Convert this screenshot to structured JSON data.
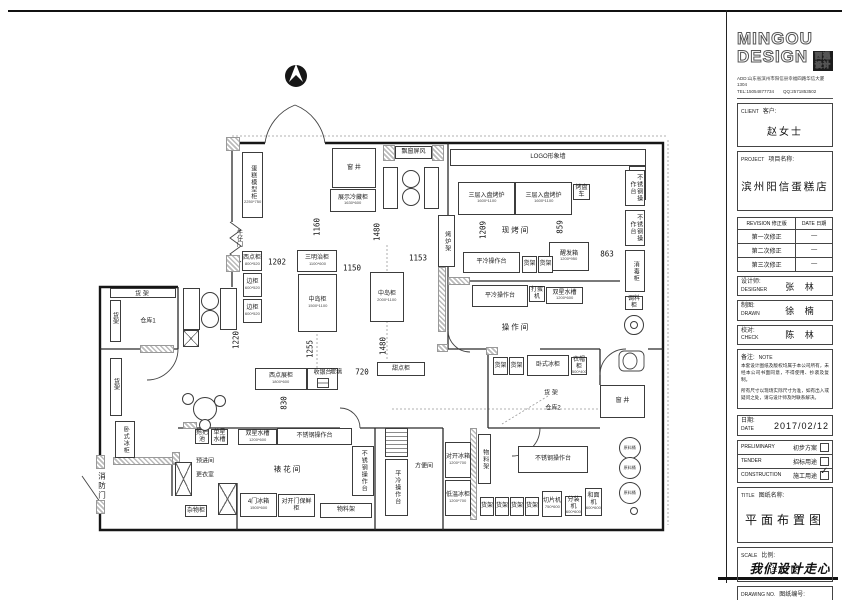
{
  "title_block": {
    "logo_line1": "MINGOU",
    "logo_line2": "DESIGN",
    "stamp_line1": "西遇",
    "stamp_line2": "设计",
    "address": "ADD:山东省滨州市阳信县幸福四路华信大厦1304",
    "tel": "TEL:15054877734　　QQ:2571853502",
    "client_en": "CLIENT",
    "client_cn": "客户:",
    "client_value": "赵女士",
    "project_en": "PROJECT",
    "project_cn": "项目名称:",
    "project_value": "滨州阳信蛋糕店",
    "revision_en": "REVISION",
    "revision_cn": "修正版",
    "date_en": "DATE",
    "date_cn": "日期",
    "revision_rows": [
      {
        "label": "第一次修正",
        "date": "—"
      },
      {
        "label": "第二次修正",
        "date": "—"
      },
      {
        "label": "第三次修正",
        "date": "—"
      }
    ],
    "designer_cn": "设计师:",
    "designer_en": "DESIGNER",
    "designer_value": "张 林",
    "drawn_cn": "制图:",
    "drawn_en": "DRAWN",
    "drawn_value": "徐 楠",
    "check_cn": "校对:",
    "check_en": "CHECK",
    "check_value": "陈 林",
    "note_cn": "备注:",
    "note_en": "NOTE",
    "note_text1": "本套设计图纸及版权均属于本公司所有，未经本公司书面同意，不得使用、抄袭及复制。",
    "note_text2": "所有尺寸以现场实际尺寸为准，如有出入或疑问之处，请与设计师及时联系解决。",
    "date_label_cn": "日期:",
    "date_label_en": "DATE",
    "date_value": "2017/02/12",
    "usage_rows": [
      {
        "en": "PRELIMINARY",
        "cn": "初步方案",
        "checked": false
      },
      {
        "en": "TENDER",
        "cn": "招标用途",
        "checked": false
      },
      {
        "en": "CONSTRUCTION",
        "cn": "施工用途",
        "checked": true
      }
    ],
    "title_en": "TITLE",
    "title_cn": "图纸名称:",
    "title_value": "平面布置图",
    "scale_en": "SCALE",
    "scale_cn": "比例:",
    "scale_value": "详见图",
    "dwgno_en": "DRAWING NO.",
    "dwgno_cn": "图纸编号:",
    "dwgno_value": "D-08",
    "slogan": "我们设计走心"
  },
  "plan": {
    "fixtures": [
      {
        "label": "蛋糕模型柜",
        "sub": "2250*750",
        "x": 242,
        "y": 152,
        "w": 21,
        "h": 66,
        "v": 1
      },
      {
        "label": "窗 井",
        "x": 332,
        "y": 148,
        "w": 44,
        "h": 40
      },
      {
        "label": "展示冷藏柜",
        "sub": "1630*600",
        "x": 330,
        "y": 189,
        "w": 46,
        "h": 23
      },
      {
        "label": "飘窗屏风",
        "x": 395,
        "y": 146,
        "w": 37,
        "h": 13
      },
      {
        "label": "",
        "x": 383,
        "y": 167,
        "w": 15,
        "h": 42
      },
      {
        "label": "",
        "x": 424,
        "y": 167,
        "w": 15,
        "h": 42
      },
      {
        "label": "LOGO形象墙",
        "x": 450,
        "y": 149,
        "w": 196,
        "h": 17
      },
      {
        "label": "",
        "x": 629,
        "y": 166,
        "w": 17,
        "h": 34
      },
      {
        "label": "三层入盘烤炉",
        "sub": "1600*1100",
        "x": 458,
        "y": 182,
        "w": 57,
        "h": 33
      },
      {
        "label": "三层入盘烤炉",
        "sub": "1600*1100",
        "x": 515,
        "y": 182,
        "w": 57,
        "h": 33
      },
      {
        "label": "烤盘车",
        "x": 573,
        "y": 184,
        "w": 17,
        "h": 16
      },
      {
        "label": "烤炉架",
        "x": 438,
        "y": 215,
        "w": 17,
        "h": 52,
        "v": 1
      },
      {
        "label": "不锈钢操作台",
        "x": 625,
        "y": 170,
        "w": 20,
        "h": 36,
        "v": 1
      },
      {
        "label": "不锈钢操作台",
        "x": 625,
        "y": 210,
        "w": 20,
        "h": 36,
        "v": 1
      },
      {
        "label": "消毒柜",
        "x": 625,
        "y": 250,
        "w": 20,
        "h": 42,
        "v": 1
      },
      {
        "label": "调料柜",
        "x": 625,
        "y": 296,
        "w": 18,
        "h": 14
      },
      {
        "label": "醒发箱",
        "sub": "1200*950",
        "x": 549,
        "y": 242,
        "w": 40,
        "h": 29
      },
      {
        "label": "平冷操作台",
        "x": 463,
        "y": 252,
        "w": 57,
        "h": 21
      },
      {
        "label": "货架",
        "x": 522,
        "y": 256,
        "w": 15,
        "h": 17
      },
      {
        "label": "货架",
        "x": 538,
        "y": 256,
        "w": 15,
        "h": 17
      },
      {
        "label": "平冷操作台",
        "x": 472,
        "y": 285,
        "w": 56,
        "h": 22
      },
      {
        "label": "打蛋机",
        "x": 529,
        "y": 286,
        "w": 16,
        "h": 16
      },
      {
        "label": "双星水槽",
        "sub": "1200*600",
        "x": 546,
        "y": 287,
        "w": 37,
        "h": 17
      },
      {
        "label": "三明治柜",
        "sub": "1100*600",
        "x": 297,
        "y": 250,
        "w": 40,
        "h": 22
      },
      {
        "label": "中岛柜",
        "sub": "1500*1100",
        "x": 298,
        "y": 274,
        "w": 39,
        "h": 58
      },
      {
        "label": "中岛柜",
        "sub": "2000*1100",
        "x": 370,
        "y": 272,
        "w": 34,
        "h": 50
      },
      {
        "label": "西点柜",
        "sub": "800*520",
        "x": 242,
        "y": 251,
        "w": 20,
        "h": 20
      },
      {
        "label": "边柜",
        "sub": "600*520",
        "x": 243,
        "y": 273,
        "w": 19,
        "h": 24
      },
      {
        "label": "边柜",
        "sub": "600*520",
        "x": 243,
        "y": 299,
        "w": 19,
        "h": 24
      },
      {
        "label": "西点展柜",
        "sub": "1800*600",
        "x": 255,
        "y": 368,
        "w": 52,
        "h": 22
      },
      {
        "label": "收银台",
        "x": 307,
        "y": 368,
        "w": 31,
        "h": 22,
        "type": "cashier"
      },
      {
        "label": "甜点柜",
        "x": 377,
        "y": 362,
        "w": 48,
        "h": 14
      },
      {
        "label": "货架",
        "x": 493,
        "y": 357,
        "w": 15,
        "h": 18
      },
      {
        "label": "货架",
        "x": 509,
        "y": 357,
        "w": 15,
        "h": 18
      },
      {
        "label": "卧式冰柜",
        "x": 527,
        "y": 355,
        "w": 42,
        "h": 21
      },
      {
        "label": "衣帽柜",
        "sub": "500*400",
        "x": 571,
        "y": 357,
        "w": 16,
        "h": 18
      },
      {
        "label": "窗 井",
        "x": 600,
        "y": 385,
        "w": 45,
        "h": 33
      },
      {
        "label": "不锈钢操作台",
        "x": 518,
        "y": 446,
        "w": 70,
        "h": 27
      },
      {
        "label": "货架",
        "x": 480,
        "y": 497,
        "w": 14,
        "h": 19
      },
      {
        "label": "货架",
        "x": 495,
        "y": 497,
        "w": 14,
        "h": 19
      },
      {
        "label": "货架",
        "x": 510,
        "y": 497,
        "w": 14,
        "h": 19
      },
      {
        "label": "货架",
        "x": 525,
        "y": 497,
        "w": 14,
        "h": 19
      },
      {
        "label": "切片机",
        "sub": "750*600",
        "x": 542,
        "y": 491,
        "w": 20,
        "h": 26
      },
      {
        "label": "分装机",
        "sub": "600*600",
        "x": 565,
        "y": 496,
        "w": 17,
        "h": 20
      },
      {
        "label": "和面机",
        "sub": "600*600",
        "x": 585,
        "y": 488,
        "w": 17,
        "h": 28
      },
      {
        "label": "物料架",
        "x": 478,
        "y": 434,
        "w": 13,
        "h": 50,
        "v": 1
      },
      {
        "label": "对开冰箱",
        "sub": "1200*700",
        "x": 445,
        "y": 442,
        "w": 26,
        "h": 36
      },
      {
        "label": "低温冰柜",
        "sub": "1200*700",
        "x": 445,
        "y": 480,
        "w": 26,
        "h": 36
      },
      {
        "label": "平冷操作台",
        "x": 385,
        "y": 459,
        "w": 23,
        "h": 57,
        "v": 1
      },
      {
        "label": "",
        "x": 385,
        "y": 428,
        "w": 23,
        "h": 29,
        "type": "rack"
      },
      {
        "label": "不锈钢操作台",
        "x": 352,
        "y": 446,
        "w": 22,
        "h": 50,
        "v": 1
      },
      {
        "label": "物料架",
        "x": 320,
        "y": 503,
        "w": 52,
        "h": 15
      },
      {
        "label": "对开门保鲜柜",
        "x": 278,
        "y": 494,
        "w": 37,
        "h": 23
      },
      {
        "label": "4门冰箱",
        "sub": "1500*600",
        "x": 240,
        "y": 493,
        "w": 37,
        "h": 24
      },
      {
        "label": "杂物柜",
        "x": 185,
        "y": 505,
        "w": 22,
        "h": 12
      },
      {
        "label": "不锈钢操作台",
        "x": 277,
        "y": 428,
        "w": 75,
        "h": 17
      },
      {
        "label": "双星水槽",
        "sub": "1200*600",
        "x": 238,
        "y": 429,
        "w": 39,
        "h": 16
      },
      {
        "label": "单星水槽",
        "x": 211,
        "y": 429,
        "w": 17,
        "h": 16
      },
      {
        "label": "拖把池",
        "x": 195,
        "y": 429,
        "w": 14,
        "h": 15
      },
      {
        "label": "卧式冰柜",
        "x": 115,
        "y": 421,
        "w": 20,
        "h": 37,
        "v": 1
      },
      {
        "label": "",
        "x": 183,
        "y": 288,
        "w": 17,
        "h": 42
      },
      {
        "label": "",
        "x": 220,
        "y": 288,
        "w": 17,
        "h": 42
      },
      {
        "label": "",
        "x": 183,
        "y": 330,
        "w": 16,
        "h": 17,
        "type": "xbox"
      },
      {
        "label": "",
        "x": 175,
        "y": 462,
        "w": 17,
        "h": 34,
        "type": "xbox"
      },
      {
        "label": "",
        "x": 218,
        "y": 483,
        "w": 19,
        "h": 32,
        "type": "xbox"
      },
      {
        "label": "",
        "x": 110,
        "y": 288,
        "w": 66,
        "h": 10
      },
      {
        "label": "",
        "x": 110,
        "y": 300,
        "w": 11,
        "h": 42
      },
      {
        "label": "",
        "x": 110,
        "y": 358,
        "w": 12,
        "h": 58
      }
    ],
    "rooms": [
      {
        "t": "现烤间",
        "x": 516,
        "y": 230
      },
      {
        "t": "操作间",
        "x": 516,
        "y": 327
      },
      {
        "t": "裱花间",
        "x": 288,
        "y": 469
      },
      {
        "t": "方便间",
        "x": 424,
        "y": 465,
        "small": 1
      },
      {
        "t": "仓库1",
        "x": 148,
        "y": 320,
        "small": 1
      },
      {
        "t": "仓库2",
        "x": 553,
        "y": 407,
        "small": 1
      },
      {
        "t": "货 架",
        "x": 142,
        "y": 293,
        "small": 1
      },
      {
        "t": "货架",
        "x": 115,
        "y": 318,
        "v": 1,
        "small": 1
      },
      {
        "t": "货架",
        "x": 116,
        "y": 384,
        "v": 1,
        "small": 1
      },
      {
        "t": "货 架",
        "x": 551,
        "y": 392,
        "small": 1
      },
      {
        "t": "牛仔门",
        "x": 239,
        "y": 238,
        "v": 1,
        "small": 1
      },
      {
        "t": "消防门",
        "x": 102,
        "y": 486,
        "v": 1
      },
      {
        "t": "预进间",
        "x": 205,
        "y": 460,
        "small": 1
      },
      {
        "t": "更衣室",
        "x": 205,
        "y": 474,
        "small": 1
      },
      {
        "t": "玻璃",
        "x": 336,
        "y": 371,
        "small": 1
      },
      {
        "t": "圆桌",
        "x": 204,
        "y": 408,
        "small": 1
      }
    ],
    "dims": [
      {
        "t": "1202",
        "x": 277,
        "y": 262
      },
      {
        "t": "1150",
        "x": 352,
        "y": 268
      },
      {
        "t": "1153",
        "x": 418,
        "y": 258
      },
      {
        "t": "863",
        "x": 607,
        "y": 254
      },
      {
        "t": "720",
        "x": 362,
        "y": 372
      },
      {
        "t": "1160",
        "x": 317,
        "y": 227,
        "v": 1
      },
      {
        "t": "1480",
        "x": 377,
        "y": 232,
        "v": 1
      },
      {
        "t": "1209",
        "x": 483,
        "y": 230,
        "v": 1
      },
      {
        "t": "859",
        "x": 560,
        "y": 227,
        "v": 1
      },
      {
        "t": "1220",
        "x": 236,
        "y": 340,
        "v": 1
      },
      {
        "t": "1255",
        "x": 310,
        "y": 349,
        "v": 1
      },
      {
        "t": "1480",
        "x": 383,
        "y": 346,
        "v": 1
      },
      {
        "t": "830",
        "x": 284,
        "y": 403,
        "v": 1
      }
    ],
    "circles": [
      {
        "cx": 410,
        "cy": 178,
        "r": 8
      },
      {
        "cx": 410,
        "cy": 196,
        "r": 8
      },
      {
        "cx": 209,
        "cy": 300,
        "r": 8
      },
      {
        "cx": 209,
        "cy": 318,
        "r": 8
      },
      {
        "cx": 204,
        "cy": 408,
        "r": 11
      },
      {
        "cx": 187,
        "cy": 398,
        "r": 5
      },
      {
        "cx": 219,
        "cy": 400,
        "r": 5
      },
      {
        "cx": 204,
        "cy": 424,
        "r": 5
      },
      {
        "label": "原料桶",
        "cx": 629,
        "cy": 447,
        "r": 10
      },
      {
        "label": "原料桶",
        "cx": 629,
        "cy": 467,
        "r": 10
      },
      {
        "label": "原料桶",
        "cx": 629,
        "cy": 492,
        "r": 10
      },
      {
        "cx": 633,
        "cy": 510,
        "r": 3
      },
      {
        "cx": 633,
        "cy": 324,
        "r": 9
      },
      {
        "cx": 633,
        "cy": 324,
        "r": 3
      }
    ],
    "hatches": [
      [
        226,
        137,
        14,
        14
      ],
      [
        226,
        255,
        14,
        17
      ],
      [
        332,
        148,
        8,
        40
      ],
      [
        368,
        148,
        8,
        40
      ],
      [
        383,
        145,
        12,
        16
      ],
      [
        432,
        145,
        12,
        16
      ],
      [
        438,
        267,
        8,
        65
      ],
      [
        448,
        277,
        22,
        8
      ],
      [
        113,
        457,
        62,
        8
      ],
      [
        470,
        428,
        7,
        92
      ],
      [
        183,
        422,
        14,
        7
      ],
      [
        140,
        345,
        34,
        8
      ],
      [
        486,
        347,
        12,
        8
      ],
      [
        437,
        344,
        11,
        8
      ],
      [
        96,
        455,
        9,
        14
      ],
      [
        96,
        500,
        9,
        14
      ],
      [
        172,
        452,
        8,
        12
      ]
    ]
  }
}
